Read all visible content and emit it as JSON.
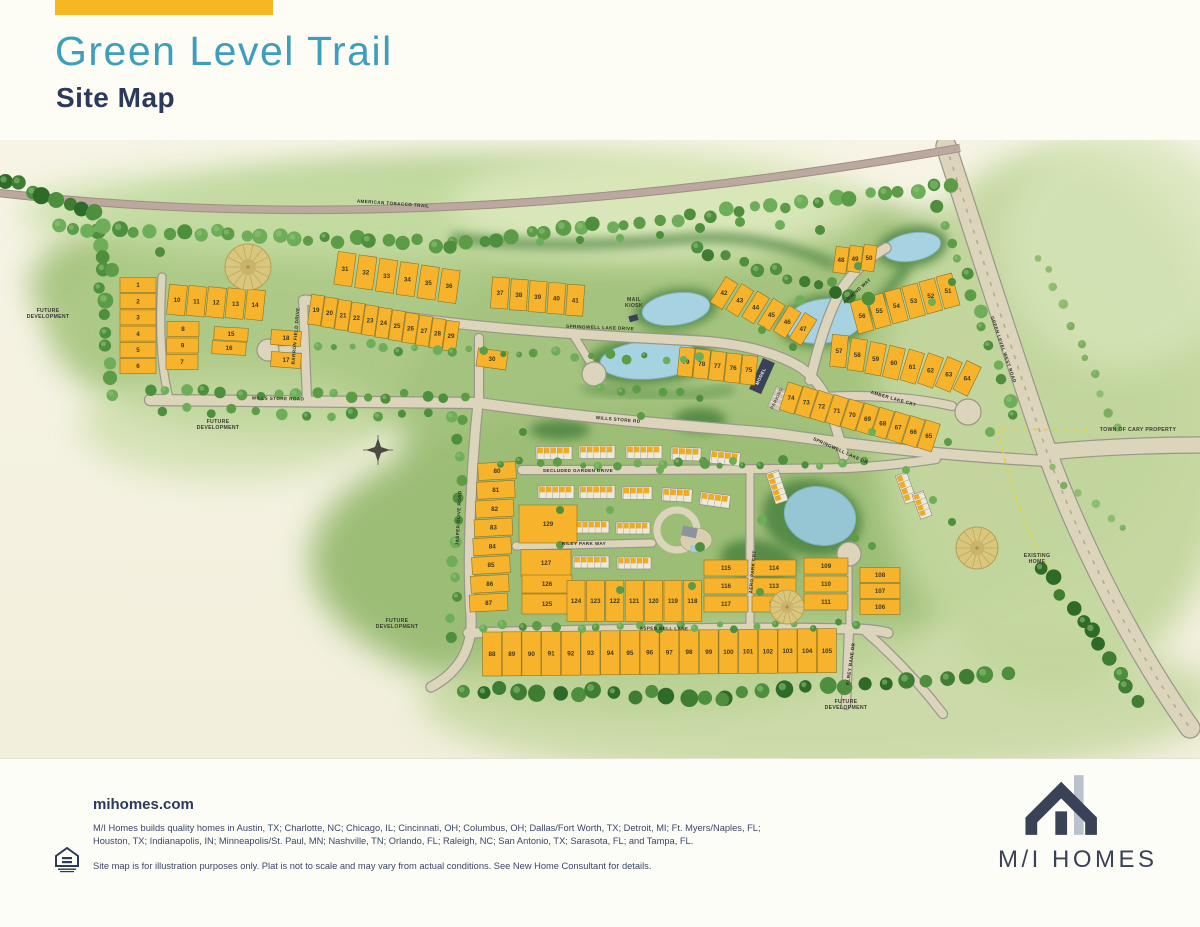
{
  "header": {
    "title": "Green Level Trail",
    "subtitle": "Site Map"
  },
  "footer": {
    "website": "mihomes.com",
    "markets": "M/I Homes builds quality homes in Austin, TX; Charlotte, NC; Chicago, IL; Cincinnati, OH; Columbus, OH; Dallas/Fort Worth, TX; Detroit, MI; Ft. Myers/Naples, FL; Houston, TX; Indianapolis, IN; Minneapolis/St. Paul, MN; Nashville, TN; Orlando, FL; Raleigh, NC; San Antonio, TX; Sarasota, FL; and Tampa, FL.",
    "disclaimer": "Site map is for illustration purposes only. Plat is not to scale and may vary from actual conditions. See New Home Consultant for details.",
    "logo_text": "M/I HOMES",
    "equal_housing_icon": "equal-housing-opportunity"
  },
  "map": {
    "colors": {
      "accent": "#F5B822",
      "title_teal": "#3E9EBE",
      "navy": "#2C3A5A",
      "lot_gold": "#F6B32B",
      "water": "#A7D2E2",
      "road": "#DCD4BB",
      "green": "#A8C581"
    },
    "road_labels": [
      {
        "text": "AMERICAN TOBACCO TRAIL",
        "x": 393,
        "y": 205,
        "rot": 4
      },
      {
        "text": "GREEN LEVEL WEST ROAD",
        "x": 1002,
        "y": 350,
        "rot": 71
      },
      {
        "text": "WILLS STORE ROAD",
        "x": 278,
        "y": 400,
        "rot": 1
      },
      {
        "text": "WILLS STORE RD",
        "x": 618,
        "y": 421,
        "rot": 5
      },
      {
        "text": "SPRINGWELL LAKE DRIVE",
        "x": 600,
        "y": 329,
        "rot": 2
      },
      {
        "text": "SPRINGWELL LAKE DR",
        "x": 840,
        "y": 452,
        "rot": 24
      },
      {
        "text": "AIRWIND WAY",
        "x": 858,
        "y": 292,
        "rot": -42
      },
      {
        "text": "AMBER LAKE CRT",
        "x": 893,
        "y": 400,
        "rot": 16
      },
      {
        "text": "JASPER OLIVE ROAD",
        "x": 460,
        "y": 518,
        "rot": -87
      },
      {
        "text": "BARRON FIELD DRIVE",
        "x": 297,
        "y": 336,
        "rot": -85
      },
      {
        "text": "SECLUDED GARDEN DRIVE",
        "x": 578,
        "y": 472,
        "rot": 0
      },
      {
        "text": "RILEY PARK WAY",
        "x": 584,
        "y": 545,
        "rot": 0
      },
      {
        "text": "ASPEN BELL LANE",
        "x": 664,
        "y": 630,
        "rot": 1
      },
      {
        "text": "AERO PARK CRT",
        "x": 754,
        "y": 572,
        "rot": -85
      },
      {
        "text": "ELREY BANE DR",
        "x": 852,
        "y": 664,
        "rot": -82
      }
    ],
    "area_labels": [
      {
        "lines": [
          "FUTURE",
          "DEVELOPMENT"
        ],
        "x": 48,
        "y": 312
      },
      {
        "lines": [
          "FUTURE",
          "DEVELOPMENT"
        ],
        "x": 218,
        "y": 423
      },
      {
        "lines": [
          "FUTURE",
          "DEVELOPMENT"
        ],
        "x": 397,
        "y": 622
      },
      {
        "lines": [
          "FUTURE",
          "DEVELOPMENT"
        ],
        "x": 846,
        "y": 703
      },
      {
        "lines": [
          "TOWN OF CARY PROPERTY"
        ],
        "x": 1138,
        "y": 431
      },
      {
        "lines": [
          "EXISTING",
          "HOME"
        ],
        "x": 1037,
        "y": 557
      },
      {
        "lines": [
          "MAIL",
          "KIOSK"
        ],
        "x": 634,
        "y": 301
      }
    ],
    "poi_labels": [
      {
        "text": "MODEL",
        "x": 762,
        "y": 377,
        "rot": -64,
        "color": "#ffffff"
      },
      {
        "text": "PARKING",
        "x": 778,
        "y": 399,
        "rot": -64,
        "color": "#55503f"
      }
    ],
    "lot_groups": [
      {
        "id": "west-col",
        "lots": [
          "1",
          "2",
          "3",
          "4",
          "5",
          "6"
        ]
      },
      {
        "id": "west-row-top",
        "lots": [
          "10",
          "11",
          "12",
          "13",
          "14"
        ]
      },
      {
        "id": "west-col-2",
        "lots": [
          "8",
          "9",
          "7"
        ]
      },
      {
        "id": "west-mid",
        "lots": [
          "15",
          "16"
        ]
      },
      {
        "id": "west-mid-2",
        "lots": [
          "18",
          "17"
        ]
      },
      {
        "id": "row-19-29",
        "lots": [
          "19",
          "20",
          "21",
          "22",
          "23",
          "24",
          "25",
          "26",
          "27",
          "28",
          "29"
        ]
      },
      {
        "id": "row-31-36",
        "lots": [
          "31",
          "32",
          "33",
          "34",
          "35",
          "36"
        ]
      },
      {
        "id": "row-37-41",
        "lots": [
          "37",
          "38",
          "39",
          "40",
          "41"
        ]
      },
      {
        "id": "lot-30",
        "lots": [
          "30"
        ]
      },
      {
        "id": "row-42-47",
        "lots": [
          "42",
          "43",
          "44",
          "45",
          "46",
          "47"
        ]
      },
      {
        "id": "row-48-50",
        "lots": [
          "48",
          "49",
          "50"
        ]
      },
      {
        "id": "row-51-56",
        "lots": [
          "56",
          "55",
          "54",
          "53",
          "52",
          "51"
        ]
      },
      {
        "id": "row-57-64",
        "lots": [
          "57",
          "58",
          "59",
          "60",
          "61",
          "62",
          "63",
          "64"
        ]
      },
      {
        "id": "row-75-79",
        "lots": [
          "79",
          "78",
          "77",
          "76",
          "75"
        ]
      },
      {
        "id": "row-65-74",
        "lots": [
          "74",
          "73",
          "72",
          "71",
          "70",
          "69",
          "68",
          "67",
          "66",
          "65"
        ]
      },
      {
        "id": "col-80-87",
        "lots": [
          "80",
          "81",
          "82",
          "83",
          "84",
          "85",
          "86",
          "87"
        ]
      },
      {
        "id": "lot-129",
        "lots": [
          "129"
        ]
      },
      {
        "id": "lot-127",
        "lots": [
          "127"
        ]
      },
      {
        "id": "lot-126",
        "lots": [
          "126"
        ]
      },
      {
        "id": "lot-125",
        "lots": [
          "125"
        ]
      },
      {
        "id": "row-118-124",
        "lots": [
          "124",
          "123",
          "122",
          "121",
          "120",
          "119",
          "118"
        ]
      },
      {
        "id": "cluster-115-117",
        "lots": [
          "115",
          "116",
          "117"
        ]
      },
      {
        "id": "cluster-112-114",
        "lots": [
          "114",
          "113",
          "112"
        ]
      },
      {
        "id": "cluster-109-111",
        "lots": [
          "109",
          "110",
          "111"
        ]
      },
      {
        "id": "cluster-106-108",
        "lots": [
          "108",
          "107",
          "106"
        ]
      },
      {
        "id": "row-88-105",
        "lots": [
          "88",
          "89",
          "90",
          "91",
          "92",
          "93",
          "94",
          "95",
          "96",
          "97",
          "98",
          "99",
          "100",
          "101",
          "102",
          "103",
          "104",
          "105"
        ]
      }
    ]
  }
}
